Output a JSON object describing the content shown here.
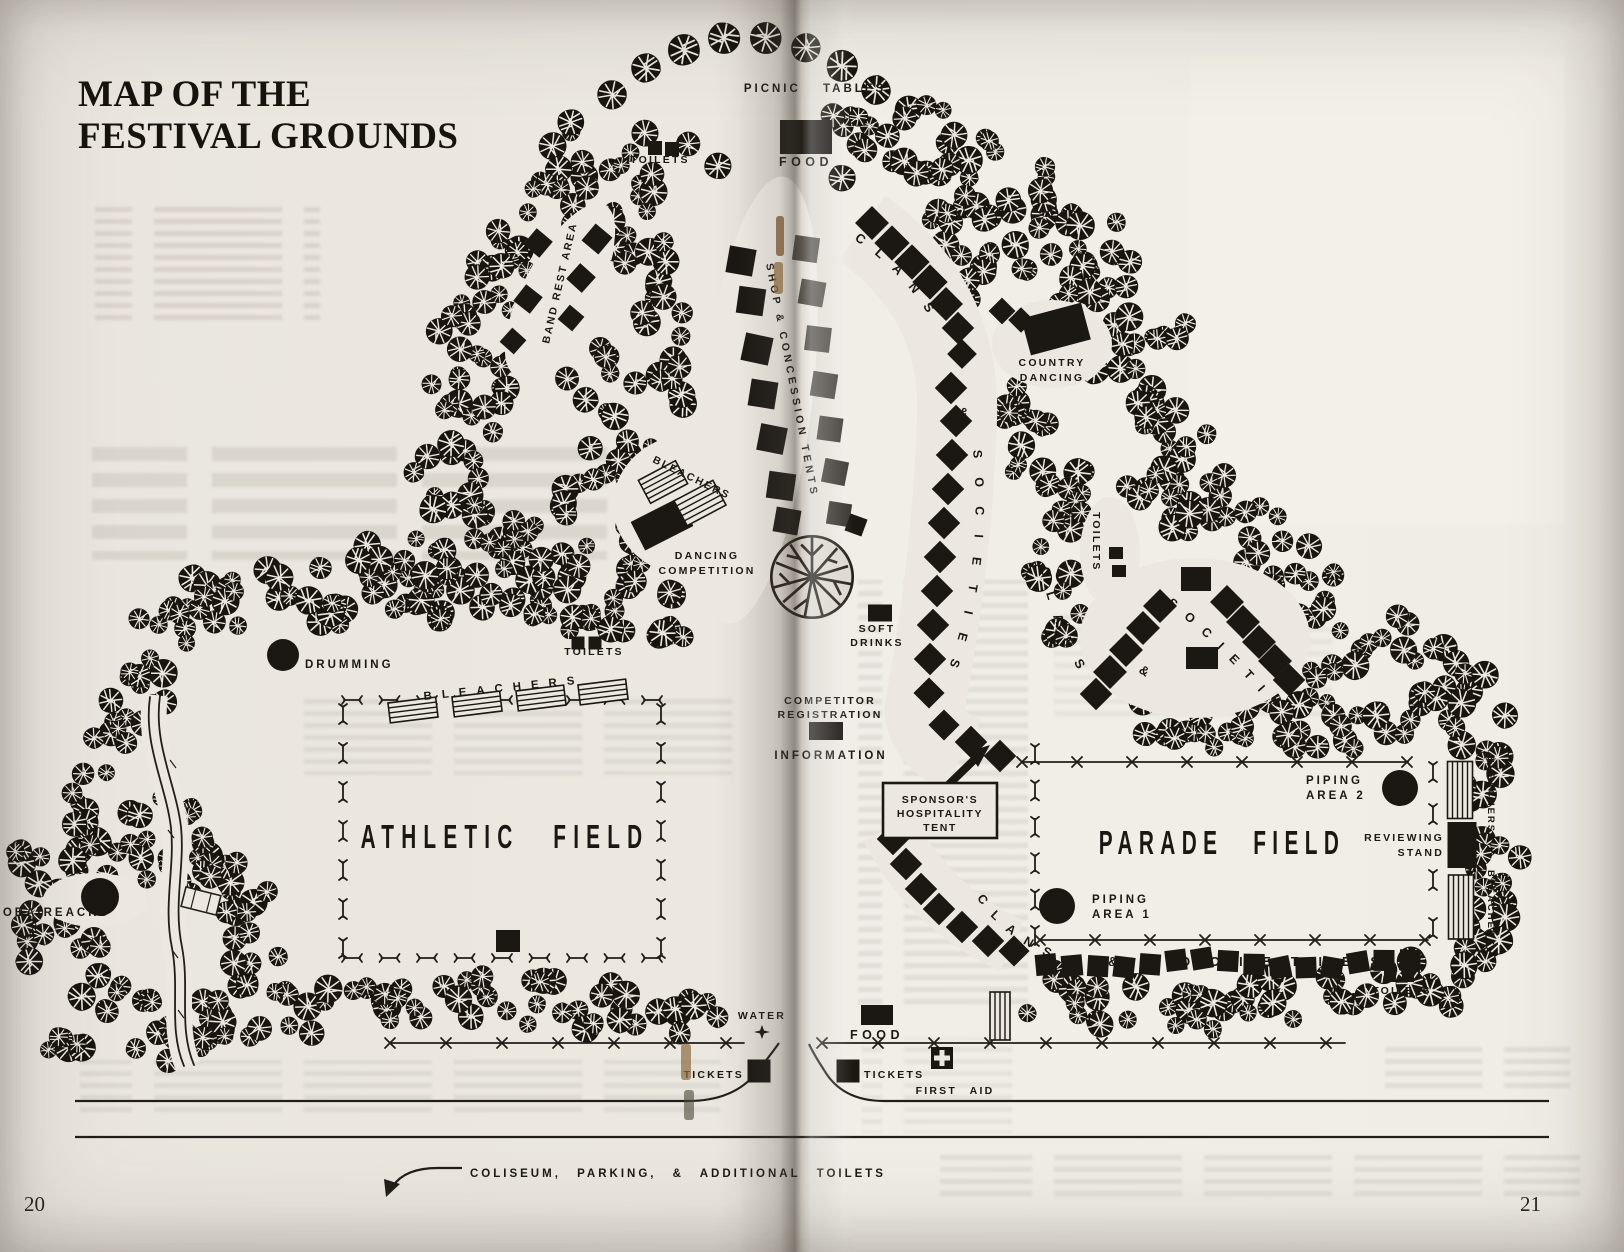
{
  "page": {
    "title_line1": "MAP OF THE",
    "title_line2": "FESTIVAL GROUNDS",
    "page_number_left": "20",
    "page_number_right": "21"
  },
  "colors": {
    "ink": "#1b1814",
    "paper": "#ece8e1"
  },
  "icons": {
    "first_aid_cross": "+",
    "water_fountain": "✦"
  },
  "labels": {
    "picnic_tables": "PICNIC TABLES",
    "toilets": "TOILETS",
    "food": "FOOD",
    "band_rest_area": "BAND REST AREA",
    "shop_concession_tents": "SHOP & CONCESSION TENTS",
    "clans": "CLANS",
    "ampersand": "&",
    "societies": "SOCIETIES",
    "country_1": "COUNTRY",
    "country_2": "DANCING",
    "bleachers": "BLEACHERS",
    "dancing_1": "DANCING",
    "dancing_2": "COMPETITION",
    "soft_1": "SOFT",
    "soft_2": "DRINKS",
    "drumming": "DRUMMING",
    "competitor_1": "COMPETITOR",
    "competitor_2": "REGISTRATION",
    "information": "INFORMATION",
    "sponsors_1": "SPONSOR'S",
    "sponsors_2": "HOSPITALITY",
    "sponsors_3": "TENT",
    "athletic_field": "ATHLETIC FIELD",
    "parade_field": "PARADE FIELD",
    "piping": "PIPING",
    "area_1": "AREA 1",
    "area_2": "AREA 2",
    "reviewing_1": "REVIEWING",
    "reviewing_2": "STAND",
    "piobaireachd": "PIOBAIREACHD",
    "water": "WATER",
    "tickets": "TICKETS",
    "first_aid": "FIRST AID",
    "coliseum_note": "COLISEUM, PARKING, & ADDITIONAL TOILETS"
  }
}
